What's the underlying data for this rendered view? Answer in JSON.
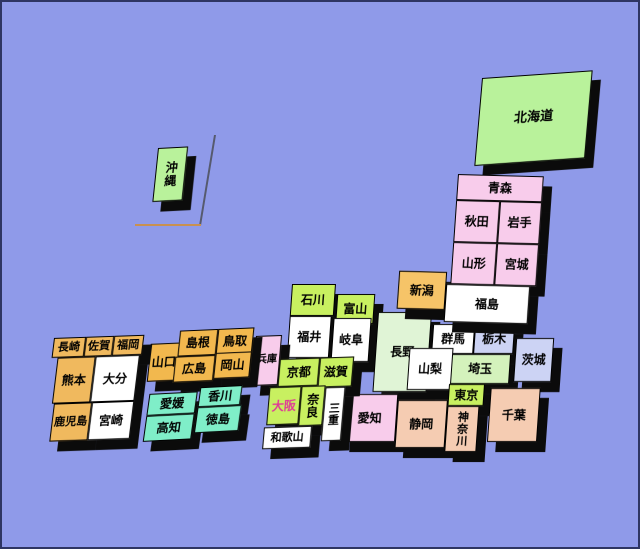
{
  "map_title": "japan-prefecture-block-map",
  "sea_color": "#8f9ae9",
  "frame_color": "#2e3563",
  "shadow_color": "#0b0b0b",
  "palette": {
    "green": "#b9f29b",
    "yg": "#c8f060",
    "pale": "#e0f4d6",
    "palegrn": "#d4f2bc",
    "pink": "#f8cceb",
    "orange_n": "#f6c468",
    "orange_c": "#f2b84e",
    "orange_k": "#f0b95e",
    "cyan": "#7feec8",
    "lav": "#ccd3f4",
    "peach": "#f5ccb2",
    "white": "#ffffff"
  },
  "osaka_label_color": "#e03898",
  "boundary": {
    "diag_color": "#565a6e",
    "horiz_color": "#c89050"
  },
  "groups": [
    {
      "id": "hokkaido",
      "x": 480,
      "y": 76,
      "skewX": -5,
      "skewY": -4,
      "blocks": [
        {
          "id": "hokkaido",
          "label": "北海道",
          "x": 0,
          "y": 0,
          "w": 110,
          "h": 88,
          "c": "green",
          "fs": 13
        }
      ]
    },
    {
      "id": "okinawa",
      "x": 156,
      "y": 146,
      "skewX": -6,
      "skewY": -3,
      "blocks": [
        {
          "id": "okinawa",
          "label": "沖縄",
          "x": 0,
          "y": 0,
          "w": 30,
          "h": 54,
          "c": "green",
          "fs": 12,
          "vert": true
        }
      ]
    },
    {
      "id": "chubu-kanto",
      "x": 286,
      "y": 282,
      "skewX": -4,
      "skewY": 0,
      "blocks": [
        {
          "id": "ishikawa",
          "label": "石川",
          "x": 4,
          "y": 0,
          "w": 44,
          "h": 32,
          "c": "yg",
          "fs": 12
        },
        {
          "id": "toyama",
          "label": "富山",
          "x": 50,
          "y": 10,
          "w": 38,
          "h": 30,
          "c": "yg",
          "fs": 12
        },
        {
          "id": "fukui",
          "label": "福井",
          "x": 4,
          "y": 32,
          "w": 42,
          "h": 42,
          "c": "white",
          "fs": 12
        },
        {
          "id": "gifu",
          "label": "岐阜",
          "x": 48,
          "y": 34,
          "w": 38,
          "h": 44,
          "c": "white",
          "fs": 12
        },
        {
          "id": "nagano",
          "label": "長野",
          "x": 92,
          "y": 28,
          "w": 54,
          "h": 80,
          "c": "pale",
          "fs": 12
        },
        {
          "id": "gunma",
          "label": "群馬",
          "x": 148,
          "y": 40,
          "w": 42,
          "h": 30,
          "c": "white",
          "fs": 12
        },
        {
          "id": "tochigi",
          "label": "栃木",
          "x": 190,
          "y": 40,
          "w": 40,
          "h": 30,
          "c": "lav",
          "fs": 12
        },
        {
          "id": "ibaraki",
          "label": "茨城",
          "x": 232,
          "y": 54,
          "w": 38,
          "h": 44,
          "c": "lav",
          "fs": 12
        },
        {
          "id": "saitama",
          "label": "埼玉",
          "x": 168,
          "y": 70,
          "w": 60,
          "h": 30,
          "c": "palegrn",
          "fs": 12
        },
        {
          "id": "yamanashi",
          "label": "山梨",
          "x": 126,
          "y": 64,
          "w": 44,
          "h": 42,
          "c": "white",
          "fs": 12
        },
        {
          "id": "tokyo",
          "label": "東京",
          "x": 168,
          "y": 100,
          "w": 36,
          "h": 22,
          "c": "yg",
          "fs": 12
        },
        {
          "id": "kanagawa",
          "label": "神奈川",
          "x": 168,
          "y": 122,
          "w": 32,
          "h": 46,
          "c": "peach",
          "fs": 11,
          "vert": true
        },
        {
          "id": "chiba",
          "label": "千葉",
          "x": 210,
          "y": 104,
          "w": 50,
          "h": 54,
          "c": "peach",
          "fs": 12
        },
        {
          "id": "shizuoka",
          "label": "静岡",
          "x": 118,
          "y": 116,
          "w": 50,
          "h": 48,
          "c": "peach",
          "fs": 12
        },
        {
          "id": "aichi",
          "label": "愛知",
          "x": 64,
          "y": 110,
          "w": 54,
          "h": 48,
          "c": "pink",
          "fs": 12
        }
      ]
    },
    {
      "id": "tohoku",
      "x": 454,
      "y": 172,
      "skewX": -4,
      "skewY": 1.5,
      "blocks": [
        {
          "id": "aomori",
          "label": "青森",
          "x": 2,
          "y": 0,
          "w": 86,
          "h": 26,
          "c": "pink",
          "fs": 12
        },
        {
          "id": "akita",
          "label": "秋田",
          "x": 2,
          "y": 26,
          "w": 44,
          "h": 42,
          "c": "pink",
          "fs": 12
        },
        {
          "id": "iwate",
          "label": "岩手",
          "x": 46,
          "y": 26,
          "w": 42,
          "h": 42,
          "c": "pink",
          "fs": 12
        },
        {
          "id": "yamagata",
          "label": "山形",
          "x": 2,
          "y": 68,
          "w": 44,
          "h": 42,
          "c": "pink",
          "fs": 12
        },
        {
          "id": "miyagi",
          "label": "宮城",
          "x": 46,
          "y": 68,
          "w": 42,
          "h": 42,
          "c": "pink",
          "fs": 12
        },
        {
          "id": "fukushima",
          "label": "福島",
          "x": -2,
          "y": 110,
          "w": 84,
          "h": 38,
          "c": "white",
          "fs": 12
        },
        {
          "id": "niigata",
          "label": "新潟",
          "x": -50,
          "y": 98,
          "w": 48,
          "h": 38,
          "c": "orange_n",
          "fs": 12
        }
      ]
    },
    {
      "id": "kansai",
      "x": 252,
      "y": 334,
      "skewX": -5,
      "skewY": -2,
      "blocks": [
        {
          "id": "hyogo",
          "label": "兵庫",
          "x": 2,
          "y": 0,
          "w": 26,
          "h": 50,
          "c": "pink",
          "fs": 10
        },
        {
          "id": "kyoto",
          "label": "京都",
          "x": 28,
          "y": 24,
          "w": 40,
          "h": 28,
          "c": "yg",
          "fs": 12
        },
        {
          "id": "shiga",
          "label": "滋賀",
          "x": 68,
          "y": 24,
          "w": 34,
          "h": 30,
          "c": "yg",
          "fs": 12
        },
        {
          "id": "osaka",
          "label": "大阪",
          "x": 20,
          "y": 52,
          "w": 32,
          "h": 38,
          "c": "yg",
          "fs": 12,
          "tc": "osaka"
        },
        {
          "id": "nara",
          "label": "奈良",
          "x": 52,
          "y": 52,
          "w": 24,
          "h": 40,
          "c": "yg",
          "fs": 12,
          "vert": true
        },
        {
          "id": "mie",
          "label": "三重",
          "x": 76,
          "y": 54,
          "w": 20,
          "h": 54,
          "c": "white",
          "fs": 11,
          "vert": true
        },
        {
          "id": "wakayama",
          "label": "和歌山",
          "x": 18,
          "y": 92,
          "w": 48,
          "h": 22,
          "c": "white",
          "fs": 11
        }
      ]
    },
    {
      "id": "chugoku",
      "x": 146,
      "y": 330,
      "skewX": -6,
      "skewY": -2.5,
      "blocks": [
        {
          "id": "yamaguchi",
          "label": "山口",
          "x": 4,
          "y": 12,
          "w": 30,
          "h": 38,
          "c": "orange_c",
          "fs": 12
        },
        {
          "id": "shimane",
          "label": "島根",
          "x": 32,
          "y": 0,
          "w": 38,
          "h": 26,
          "c": "orange_c",
          "fs": 12
        },
        {
          "id": "tottori",
          "label": "鳥取",
          "x": 70,
          "y": 0,
          "w": 36,
          "h": 26,
          "c": "orange_c",
          "fs": 12
        },
        {
          "id": "hiroshima",
          "label": "広島",
          "x": 30,
          "y": 26,
          "w": 40,
          "h": 26,
          "c": "orange_c",
          "fs": 12
        },
        {
          "id": "okayama",
          "label": "岡山",
          "x": 70,
          "y": 24,
          "w": 36,
          "h": 26,
          "c": "orange_c",
          "fs": 12
        }
      ]
    },
    {
      "id": "shikoku",
      "x": 146,
      "y": 388,
      "skewX": -8,
      "skewY": -3,
      "blocks": [
        {
          "id": "ehime",
          "label": "愛媛",
          "x": 2,
          "y": 4,
          "w": 48,
          "h": 22,
          "c": "cyan",
          "fs": 12
        },
        {
          "id": "kagawa",
          "label": "香川",
          "x": 52,
          "y": 0,
          "w": 42,
          "h": 20,
          "c": "cyan",
          "fs": 12
        },
        {
          "id": "kochi",
          "label": "高知",
          "x": 2,
          "y": 26,
          "w": 48,
          "h": 26,
          "c": "cyan",
          "fs": 12
        },
        {
          "id": "tokushima",
          "label": "徳島",
          "x": 52,
          "y": 20,
          "w": 44,
          "h": 26,
          "c": "cyan",
          "fs": 12
        }
      ]
    },
    {
      "id": "kyushu",
      "x": 50,
      "y": 336,
      "skewX": -7,
      "skewY": -2,
      "blocks": [
        {
          "id": "nagasaki",
          "label": "長崎",
          "x": 2,
          "y": 0,
          "w": 32,
          "h": 20,
          "c": "orange_k",
          "fs": 11
        },
        {
          "id": "saga",
          "label": "佐賀",
          "x": 34,
          "y": 0,
          "w": 28,
          "h": 20,
          "c": "orange_k",
          "fs": 11
        },
        {
          "id": "fukuoka",
          "label": "福岡",
          "x": 62,
          "y": 0,
          "w": 30,
          "h": 20,
          "c": "orange_k",
          "fs": 11
        },
        {
          "id": "kumamoto",
          "label": "熊本",
          "x": 8,
          "y": 20,
          "w": 38,
          "h": 46,
          "c": "orange_k",
          "fs": 12
        },
        {
          "id": "oita",
          "label": "大分",
          "x": 46,
          "y": 20,
          "w": 44,
          "h": 46,
          "c": "white",
          "fs": 12
        },
        {
          "id": "kagoshima",
          "label": "鹿児島",
          "x": 10,
          "y": 66,
          "w": 38,
          "h": 38,
          "c": "orange_k",
          "fs": 11
        },
        {
          "id": "miyazaki",
          "label": "宮崎",
          "x": 48,
          "y": 66,
          "w": 42,
          "h": 38,
          "c": "white",
          "fs": 12
        }
      ]
    }
  ]
}
